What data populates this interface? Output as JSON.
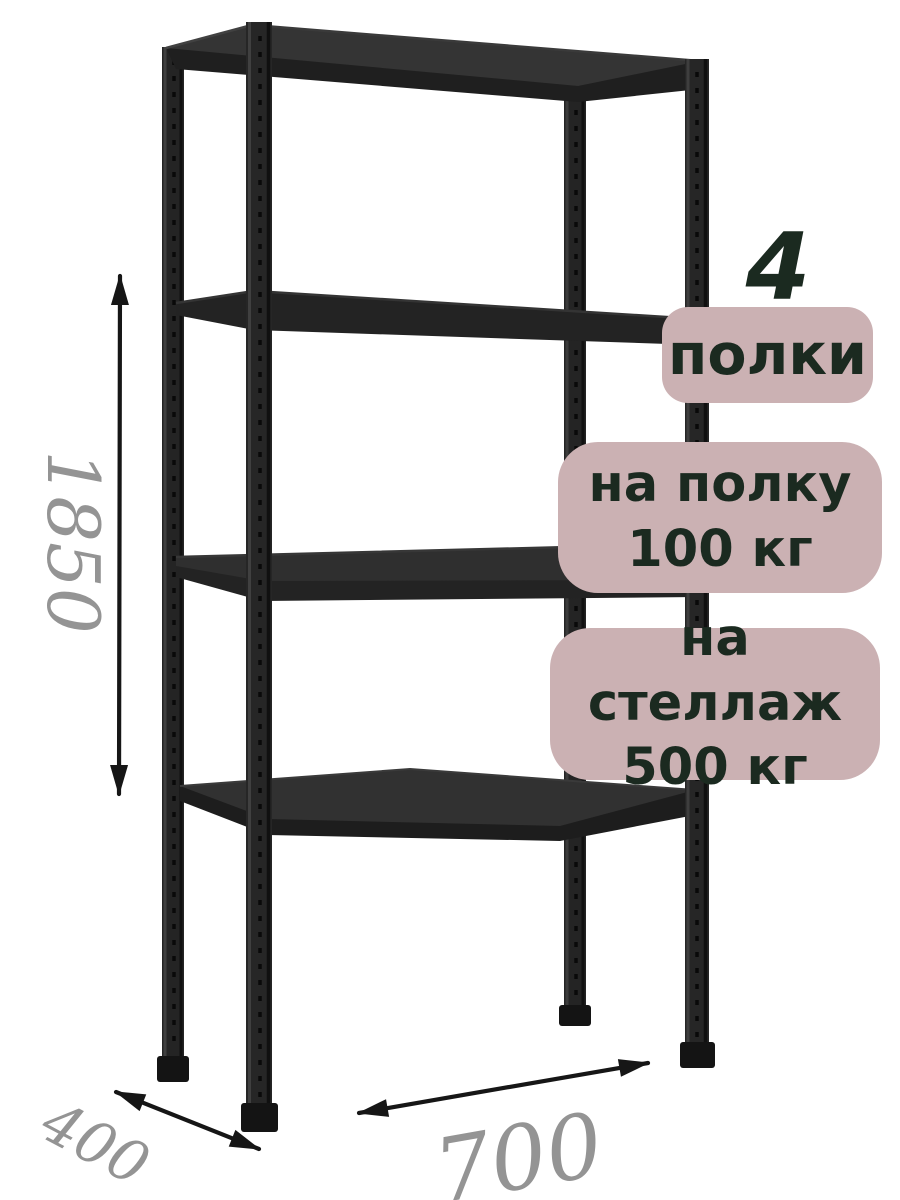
{
  "image": {
    "background": "#ffffff",
    "subject": "Черный металлический стеллаж с четырьмя полками (black metal shelving rack, dimensioned product render)"
  },
  "rack": {
    "frame_color": "#232323",
    "shelf_count": 4,
    "post_count": 4
  },
  "dimensions": {
    "height": "1850",
    "depth": "400",
    "width": "700"
  },
  "badges": {
    "count_number": "4",
    "count_label": "полки",
    "per_shelf_line1": "на полку",
    "per_shelf_line2": "100 кг",
    "per_rack_line1": "на стеллаж",
    "per_rack_line2": "500 кг"
  },
  "colors": {
    "badge_bg": "#cbb1b3",
    "badge_text": "#1b2a20",
    "dimension_text": "#949494",
    "arrow": "#161616"
  }
}
